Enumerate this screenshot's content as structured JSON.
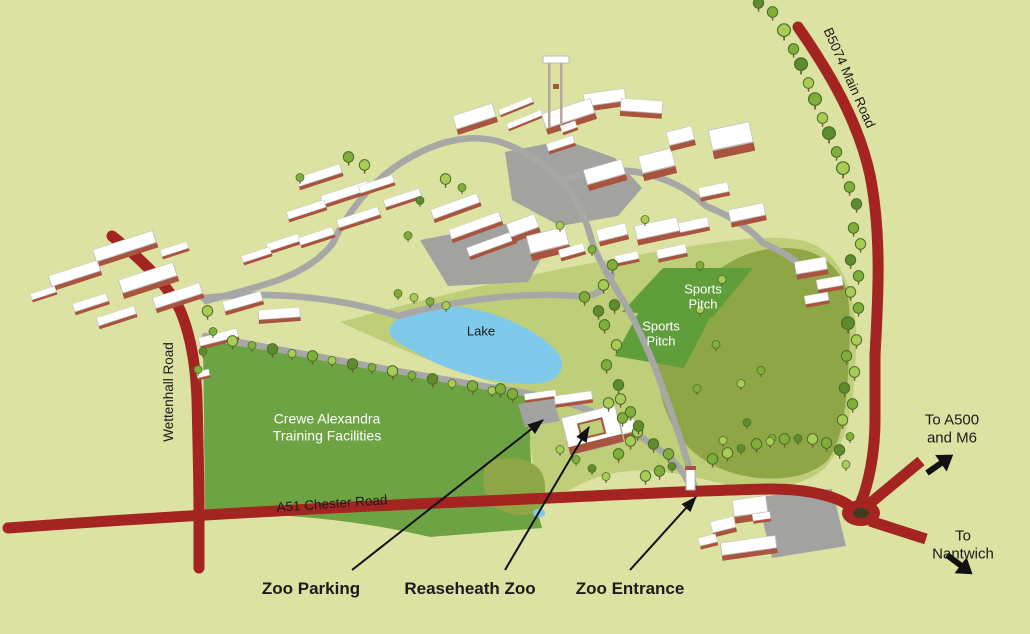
{
  "map": {
    "labels": {
      "road_b5074": "B5074 Main Road",
      "road_wettenhall": "Wettenhall Road",
      "road_a51": "A51 Chester Road",
      "lake": "Lake",
      "training_facilities": "Crewe Alexandra\nTraining Facilities",
      "sports_pitch_1": "Sports\nPitch",
      "sports_pitch_2": "Sports\nPitch",
      "to_a500": "To A500 and M6",
      "to_nantwich": "To Nantwich",
      "zoo_parking": "Zoo Parking",
      "reaseheath_zoo": "Reaseheath Zoo",
      "zoo_entrance": "Zoo Entrance"
    },
    "colors": {
      "background": "#dce2a2",
      "main_road_red": "#a32421",
      "campus_road_gray": "#a7a7a5",
      "training_field_green": "#6da342",
      "sports_pitch_green": "#5f9e3b",
      "zoo_field_olive": "#8fa647",
      "meadow_light_green": "#bfce79",
      "lake_blue": "#7fc9ea",
      "building_wall": "#a8543e",
      "building_roof": "#ffffff",
      "label_dark": "#1b1b1b",
      "label_light": "#ffffff"
    }
  }
}
